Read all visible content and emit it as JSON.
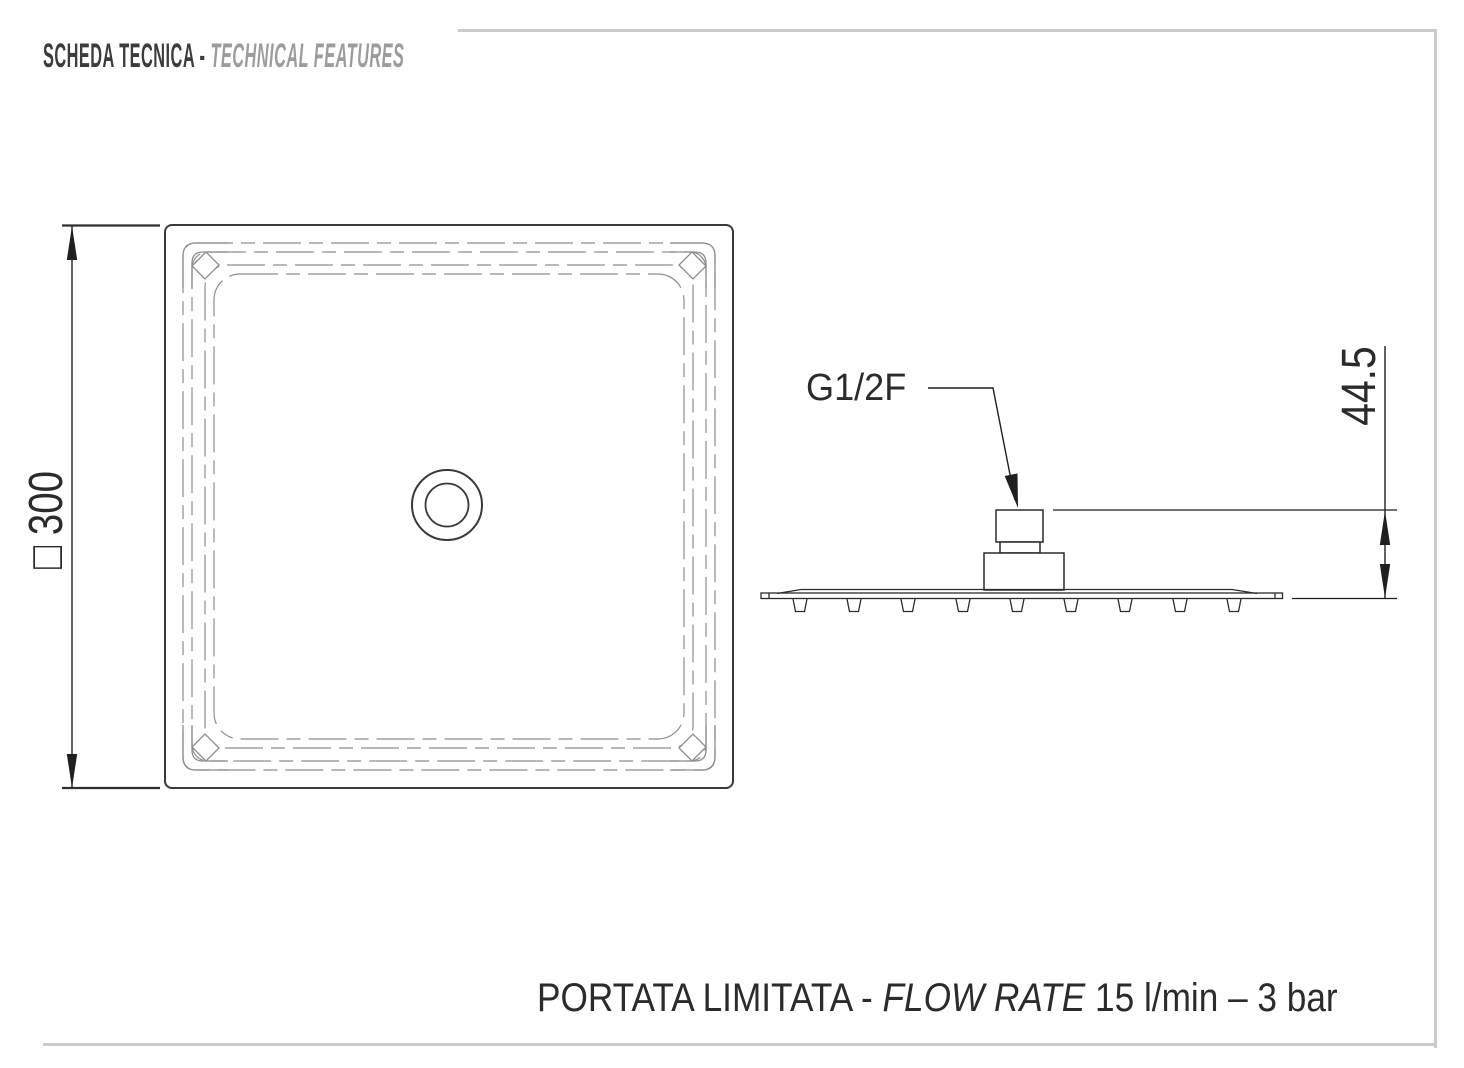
{
  "header": {
    "title_primary": "SCHEDA TECNICA - ",
    "title_secondary": "TECHNICAL FEATURES"
  },
  "plan_view": {
    "dimension_side_label": "□ 300"
  },
  "side_view": {
    "connector_label": "G1/2F",
    "height_dimension_label": "44.5"
  },
  "caption": {
    "primary": "PORTATA LIMITATA - ",
    "italic": "FLOW RATE",
    "suffix": " 15 l/min – 3 bar"
  },
  "colors": {
    "line_dark": "#2b2b2b",
    "line_gray": "#8d8d8d",
    "rule_gray": "#cbcbcb",
    "title_dark": "#3c3c3c",
    "title_gray": "#9c9c9c"
  }
}
